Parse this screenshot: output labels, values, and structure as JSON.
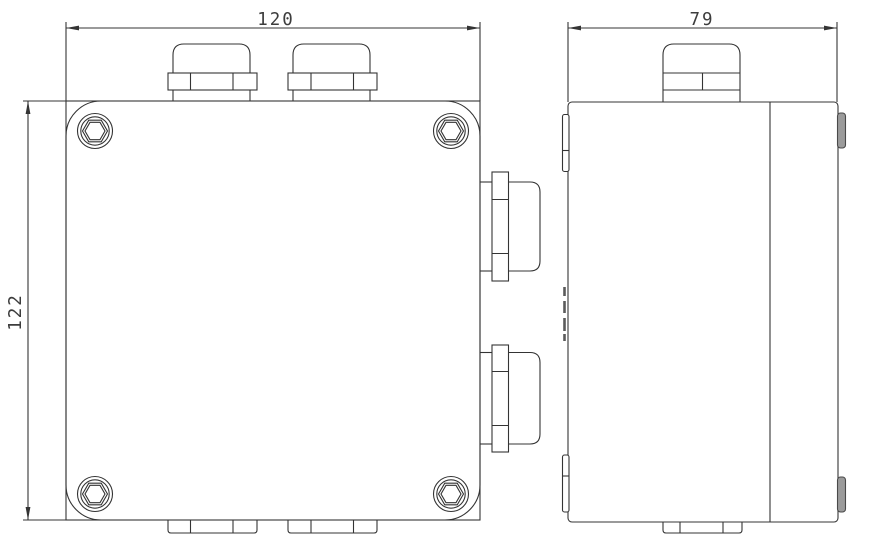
{
  "drawing": {
    "title": "enclosure-two-view-dimension-drawing",
    "background": "#ffffff",
    "line_color": "#343434",
    "tab_fill": "#9b9b9b",
    "tab_stroke": "#4a4a4a",
    "dimensions": {
      "width": {
        "value": "120",
        "orientation": "horizontal",
        "view": "front"
      },
      "height": {
        "value": "122",
        "orientation": "vertical",
        "view": "front"
      },
      "depth": {
        "value": "79",
        "orientation": "horizontal",
        "view": "side"
      }
    },
    "views": {
      "front": {
        "name": "front view",
        "features": [
          "4 corner hex-socket screws",
          "2 top cable glands",
          "2 right cable glands",
          "2 bottom gland stubs"
        ]
      },
      "side": {
        "name": "side view",
        "features": [
          "1 top cable gland",
          "1 bottom gland stub",
          "lid split line",
          "edge tabs"
        ]
      }
    }
  }
}
